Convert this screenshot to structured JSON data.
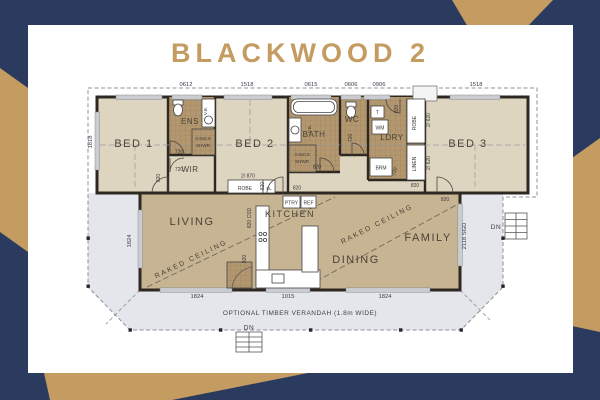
{
  "title": "BLACKWOOD 2",
  "colors": {
    "navy": "#2b3a5f",
    "gold": "#c49b60",
    "wall": "#2e2822",
    "bedroom_floor": "#ded5c0",
    "living_floor": "#c7b493",
    "wet_area_tile": "#b29770",
    "verandah": "#e4e6eb"
  },
  "plan": {
    "rooms": {
      "bed1": "BED 1",
      "ens": "ENS",
      "wir": "WIR",
      "bed2": "BED 2",
      "bath": "BATH",
      "wc": "WC",
      "ldry": "LDRY",
      "bed3": "BED 3",
      "living": "LIVING",
      "kitchen": "KITCHEN",
      "dining": "DINING",
      "family": "FAMILY"
    },
    "closets": {
      "robe_bed2": "ROBE",
      "robe_sl": "SL",
      "robe_tall": "ROBE",
      "linen": "LINEN",
      "brm": "BRM",
      "ptry": "PTRY",
      "ref": "REF"
    },
    "fixtures": {
      "tub": "T",
      "wm": "WM",
      "vb_ens": "V.B.",
      "vb_bath": "V.B.",
      "shwr_ens_1": "0.9x0.9",
      "shwr_ens_2": "SHWR",
      "shwr_bath_1": "0.9x0.9",
      "shwr_bath_2": "SHWR"
    },
    "dims": {
      "top": [
        "0612",
        "1518",
        "0615",
        "0606",
        "0906",
        "1518"
      ],
      "left": [
        "1818",
        "1824"
      ],
      "bottom": [
        "1824",
        "1015",
        "1824"
      ],
      "right": [
        "2118 SGD"
      ]
    },
    "doors": {
      "ens_720": "720",
      "wir_720": "720",
      "wc_720": "720",
      "brm_720": "720",
      "bed1_820": "820",
      "bed2_820": "820",
      "hall_820": "820",
      "hall2_820": "820",
      "bath_820": "820",
      "ldry_820": "820",
      "bed3_820": "820",
      "pantry_820": "820",
      "robe_870": "2/ 870",
      "robe_620": "2/ 620",
      "linen_620": "2/ 620",
      "kitchen_csd": "820 CSD"
    },
    "notes": {
      "raked_living": "RAKED CEILING",
      "raked_family": "RAKED  CEILING",
      "verandah": "OPTIONAL TIMBER VERANDAH (1.8m WIDE)",
      "dn_bottom": "DN",
      "dn_right": "DN"
    }
  }
}
